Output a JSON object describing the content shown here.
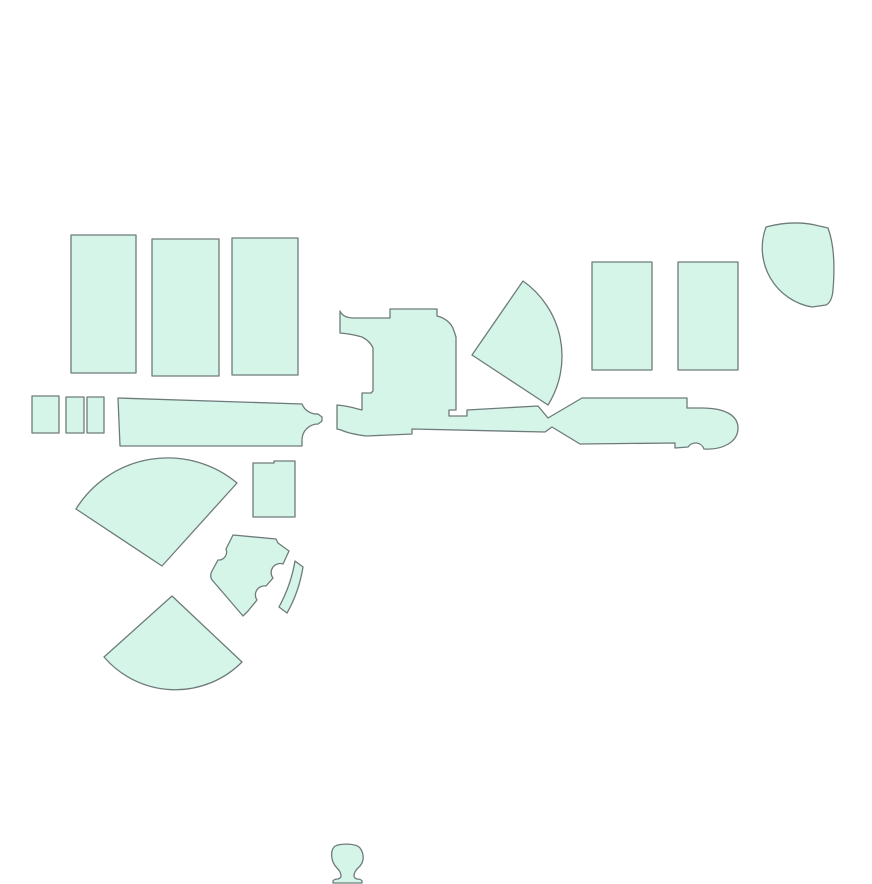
{
  "canvas": {
    "width": 884,
    "height": 884,
    "background": "#ffffff"
  },
  "map": {
    "description": "Footprint map of pale mint-green building/section outlines on a plain white background",
    "colors": {
      "shape_fill": "#d6f5e9",
      "shape_outline": "#6e7b7b",
      "background": "#ffffff"
    },
    "shapes": [
      {
        "name": "block-northwest-1",
        "d": "M 71,235 L 136,235 L 136,373 L 71,373 Z"
      },
      {
        "name": "block-northwest-2",
        "d": "M 152,239 L 219,239 L 219,376 L 152,376 Z"
      },
      {
        "name": "block-northwest-3",
        "d": "M 232,238 L 298,238 L 298,375 L 232,375 Z"
      },
      {
        "name": "small-block-west-1",
        "d": "M 32,396 L 59,396 L 59,433 L 32,433 Z"
      },
      {
        "name": "small-block-west-2",
        "d": "M 66,397 L 84,397 L 84,433 L 66,433 Z"
      },
      {
        "name": "small-block-west-3",
        "d": "M 87,397 L 104,397 L 104,433 L 87,433 Z"
      },
      {
        "name": "long-bar-west",
        "d": "M 118,398 L 302,404 A 16 16 0 0 0 318,414 L 322,417 L 322,421 L 318,424 A 16 16 0 0 0 302,440 L 302,446 L 120,446 Z"
      },
      {
        "name": "central-complex",
        "d": "M 340,311 Q 343,318 354,318 L 390,318 L 390,309 L 437,309 L 437,316 C 446,318 452,324 454,331 L 456,337 L 456,410 L 449,410 L 449,416 L 467,416 L 467,410 L 538,406 L 548,418 L 582,398 L 687,398 L 687,408 L 702,408 C 724,408 738,415 738,428 C 738,442 723,450 704,449 A 9 9 0 0 0 688,447 L 675,448 L 675,443 L 580,444 L 552,427 L 545,432 L 412,429 L 412,434 L 366,436 Q 350,434 341,430 L 337,429 L 337,405 Q 348,406 358,409 L 362,410 L 362,393 L 371,393 L 373,391 L 373,348 Q 370,341 362,337 Q 352,334 340,333 Z"
      },
      {
        "name": "fan-center",
        "d": "M 472,355 L 523,281 A 92 92 0 0 1 548,405 Z"
      },
      {
        "name": "fan-west-upper",
        "d": "M 162,566 L 237,483 A 108 108 0 0 0 76,509 Z"
      },
      {
        "name": "small-block-center",
        "d": "M 253,463 L 274,463 L 274,461 L 295,461 L 295,517 L 253,517 Z"
      },
      {
        "name": "notched-polygon",
        "d": "M 233,535 L 276,539 L 278,543 L 289,551 L 283,564 A 9 9 0 0 0 273,578 L 266,586 A 9 9 0 0 0 257,600 L 248,611 L 243,616 L 213,581 Q 209,577 212,571 L 218,560 A 8 8 0 0 0 226,549 L 233,535 Z"
      },
      {
        "name": "curved-strip",
        "d": "M 295,561 L 303,567 Q 299,592 287,613 L 279,607 Q 291,585 295,561 Z"
      },
      {
        "name": "fan-west-lower",
        "d": "M 172,596 L 242,662 A 94 94 0 0 1 104,657 Z"
      },
      {
        "name": "block-northeast-1",
        "d": "M 592,262 L 652,262 L 652,370 L 592,370 Z"
      },
      {
        "name": "block-northeast-2",
        "d": "M 678,262 L 738,262 L 738,370 L 678,370 Z"
      },
      {
        "name": "round-block-northeast",
        "d": "M 766,227 Q 792,220 815,225 L 828,228 C 834,244 835,266 833,290 Q 832,302 826,305 L 812,307 A 60 60 0 0 1 766,227 Z"
      },
      {
        "name": "small-figure-south",
        "d": "M 334,847 C 338,843 356,843 360,848 C 365,855 364,863 358,868 C 355,871 354,873 354,876 Q 354,878 357,879 Q 361,879 362,881 L 362,883 L 333,883 L 333,881 Q 334,879 338,879 Q 341,878 341,876 C 341,873 340,871 337,868 C 331,862 330,852 334,847 Z"
      }
    ]
  }
}
